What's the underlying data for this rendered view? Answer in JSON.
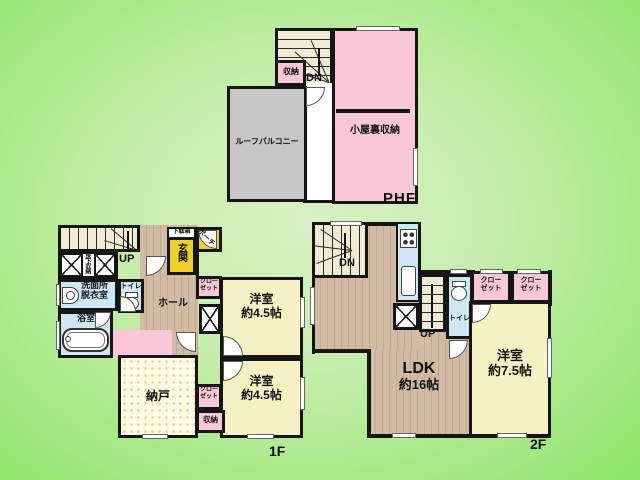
{
  "palette": {
    "background_green": "#9fe77f",
    "wall_black": "#151515",
    "closet_pink": "#f8c8d8",
    "bedroom_pale_yellow": "#f6f1c3",
    "entrance_yellow": "#eed029",
    "wet_area_blue": "#cfe7f2",
    "wood_floor_tan": "#cfb8a2",
    "balcony_gray": "#c6c6c6",
    "stairs_cream": "#f1ead4",
    "storage_dot_yellow": "#f3d87a"
  },
  "phf": {
    "floor_label": "PHF",
    "attic_storage": "小屋裏収納",
    "storage": "収納",
    "roof_balcony": "ルーフバルコニー",
    "stairs_down": "DN"
  },
  "f1": {
    "floor_label": "1F",
    "stairs_up": "UP",
    "underfloor_storage": "床下収納",
    "washroom": [
      "洗面所",
      "脱衣室"
    ],
    "toilet": "トイレ",
    "hall": "ホール",
    "entrance": "玄関",
    "shoe_cabinet": "下駄箱",
    "porch": "ポーチ",
    "closet_top": [
      "クロー",
      "ゼット"
    ],
    "bedroom_a": [
      "洋室",
      "約4.5帖"
    ],
    "bedroom_b": [
      "洋室",
      "約4.5帖"
    ],
    "storage_room": "納戸",
    "closet_bottom": [
      "クロー",
      "ゼット"
    ],
    "storage": "収納",
    "bath": "浴室"
  },
  "f2": {
    "floor_label": "2F",
    "stairs_down": "DN",
    "stairs_up": "UP",
    "toilet": "トイレ",
    "closet_1": [
      "クロー",
      "ゼット"
    ],
    "closet_2": [
      "クロー",
      "ゼット"
    ],
    "ldk": [
      "LDK",
      "約16帖"
    ],
    "bedroom": [
      "洋室",
      "約7.5帖"
    ]
  }
}
